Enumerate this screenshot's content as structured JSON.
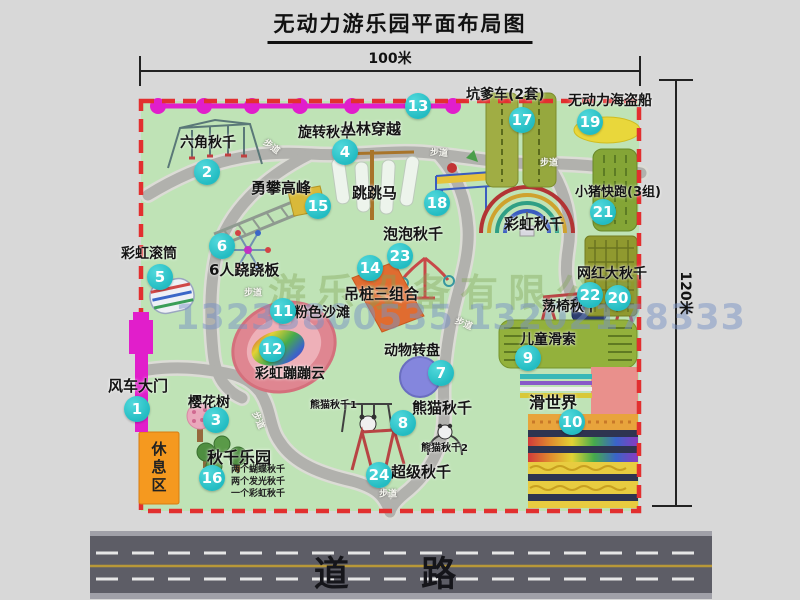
{
  "title": "无动力游乐园平面布局图",
  "dimensions": {
    "width_label": "100米",
    "height_label": "120米"
  },
  "road": {
    "label": "道 路"
  },
  "watermark": {
    "company": "游乐设备有限公司",
    "phone": "13233800535 13202178333"
  },
  "rest_area": {
    "label": "休息区"
  },
  "trail_label": "步道",
  "extra_labels": {
    "rainbow_swing": "彩虹秋千",
    "panda_swing_1": "熊猫秋千1",
    "panda_swing_2": "熊猫秋千2"
  },
  "swing_notes": [
    "两个蝴蝶秋千",
    "两个发光秋千",
    "一个彩虹秋千"
  ],
  "attractions": [
    {
      "num": "1",
      "label": "风车大门"
    },
    {
      "num": "2",
      "label": "六角秋千"
    },
    {
      "num": "3",
      "label": "樱花树"
    },
    {
      "num": "4",
      "label": "旋转秋千"
    },
    {
      "num": "5",
      "label": "彩虹滚筒"
    },
    {
      "num": "6",
      "label": "6人跷跷板"
    },
    {
      "num": "7",
      "label": "动物转盘"
    },
    {
      "num": "8",
      "label": "熊猫秋千"
    },
    {
      "num": "9",
      "label": "儿童滑索"
    },
    {
      "num": "10",
      "label": "滑世界"
    },
    {
      "num": "11",
      "label": "粉色沙滩"
    },
    {
      "num": "12",
      "label": "彩虹蹦蹦云"
    },
    {
      "num": "13",
      "label": "丛林穿越"
    },
    {
      "num": "14",
      "label": "吊桩三组合"
    },
    {
      "num": "15",
      "label": "勇攀高峰"
    },
    {
      "num": "16",
      "label": "秋千乐园"
    },
    {
      "num": "17",
      "label": "坑爹车(2套)"
    },
    {
      "num": "18",
      "label": "跳跳马"
    },
    {
      "num": "19",
      "label": "无动力海盗船"
    },
    {
      "num": "20",
      "label": "网红大秋千"
    },
    {
      "num": "21",
      "label": "小猪快跑(3组)"
    },
    {
      "num": "22",
      "label": "荡椅秋千"
    },
    {
      "num": "23",
      "label": "泡泡秋千"
    },
    {
      "num": "24",
      "label": "超级秋千"
    }
  ],
  "colors": {
    "map_green": "#bfe3b6",
    "border_red": "#e22f2f",
    "path_gray": "#b1b1ad",
    "badge_teal": "#23bcc2",
    "magenta": "#e11ecb",
    "olive": "#93a93a",
    "pirate_yellow": "#e9d73b",
    "rest_orange": "#f5991f",
    "beach_pink": "#df8691",
    "turntable_purple": "#8486dd",
    "road_gray": "#5d5d66"
  }
}
